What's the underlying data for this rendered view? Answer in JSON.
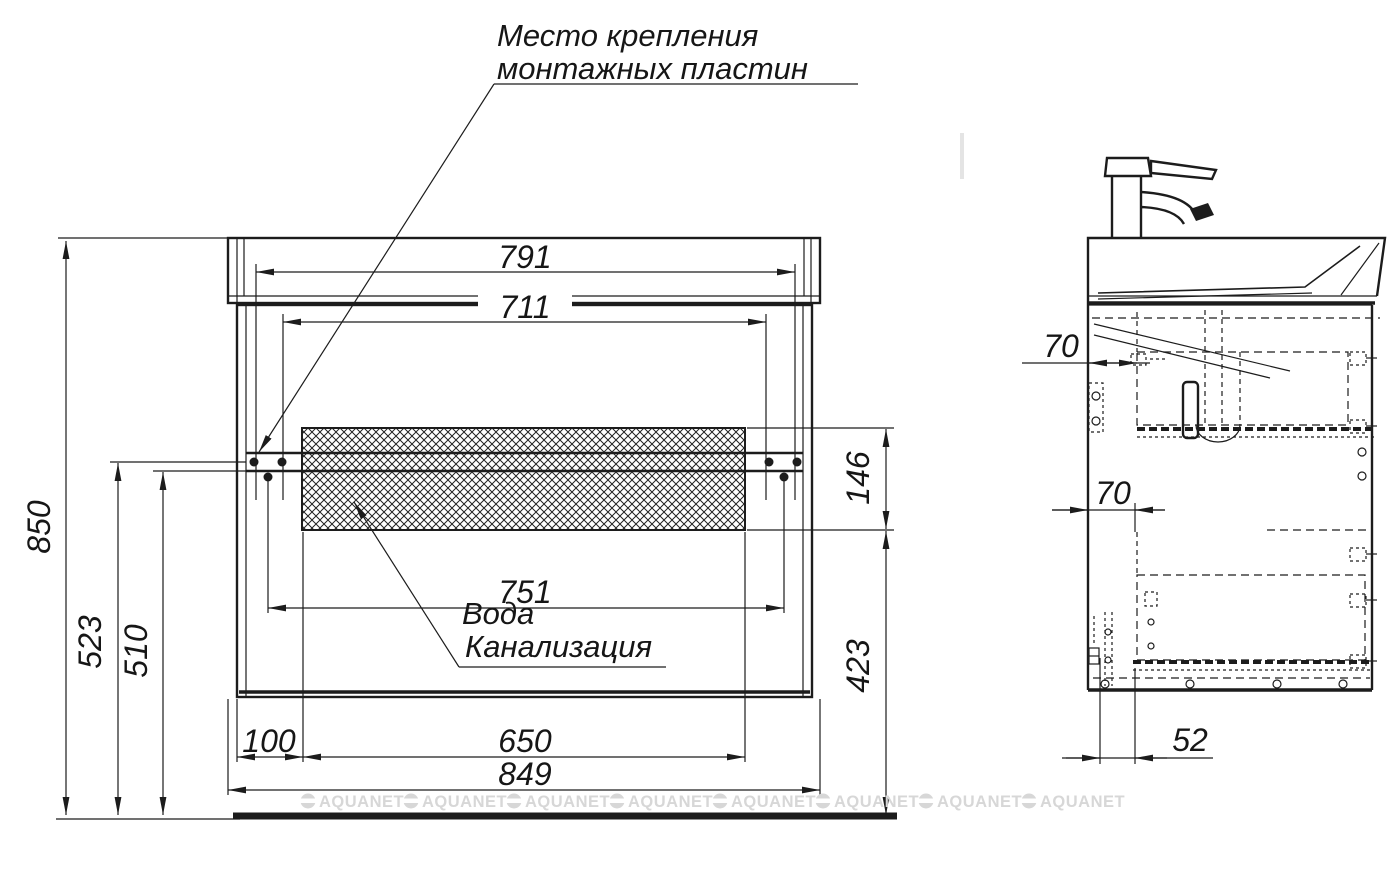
{
  "drawing": {
    "title": {
      "line1": "Место крепления",
      "line2": "монтажных пластин"
    },
    "notes": {
      "water": "Вода",
      "sewage": "Канализация"
    },
    "front": {
      "dim_791": "791",
      "dim_711": "711",
      "dim_751": "751",
      "dim_650": "650",
      "dim_100": "100",
      "dim_849": "849",
      "dim_850": "850",
      "dim_523": "523",
      "dim_510": "510",
      "dim_146": "146",
      "dim_423": "423"
    },
    "side": {
      "dim_70_top": "70",
      "dim_70_mid": "70",
      "dim_52": "52"
    },
    "watermark": {
      "text": "AQUANET"
    },
    "colors": {
      "line": "#1c1c1c",
      "watermark": "#d7d7d7",
      "background": "#ffffff"
    }
  }
}
